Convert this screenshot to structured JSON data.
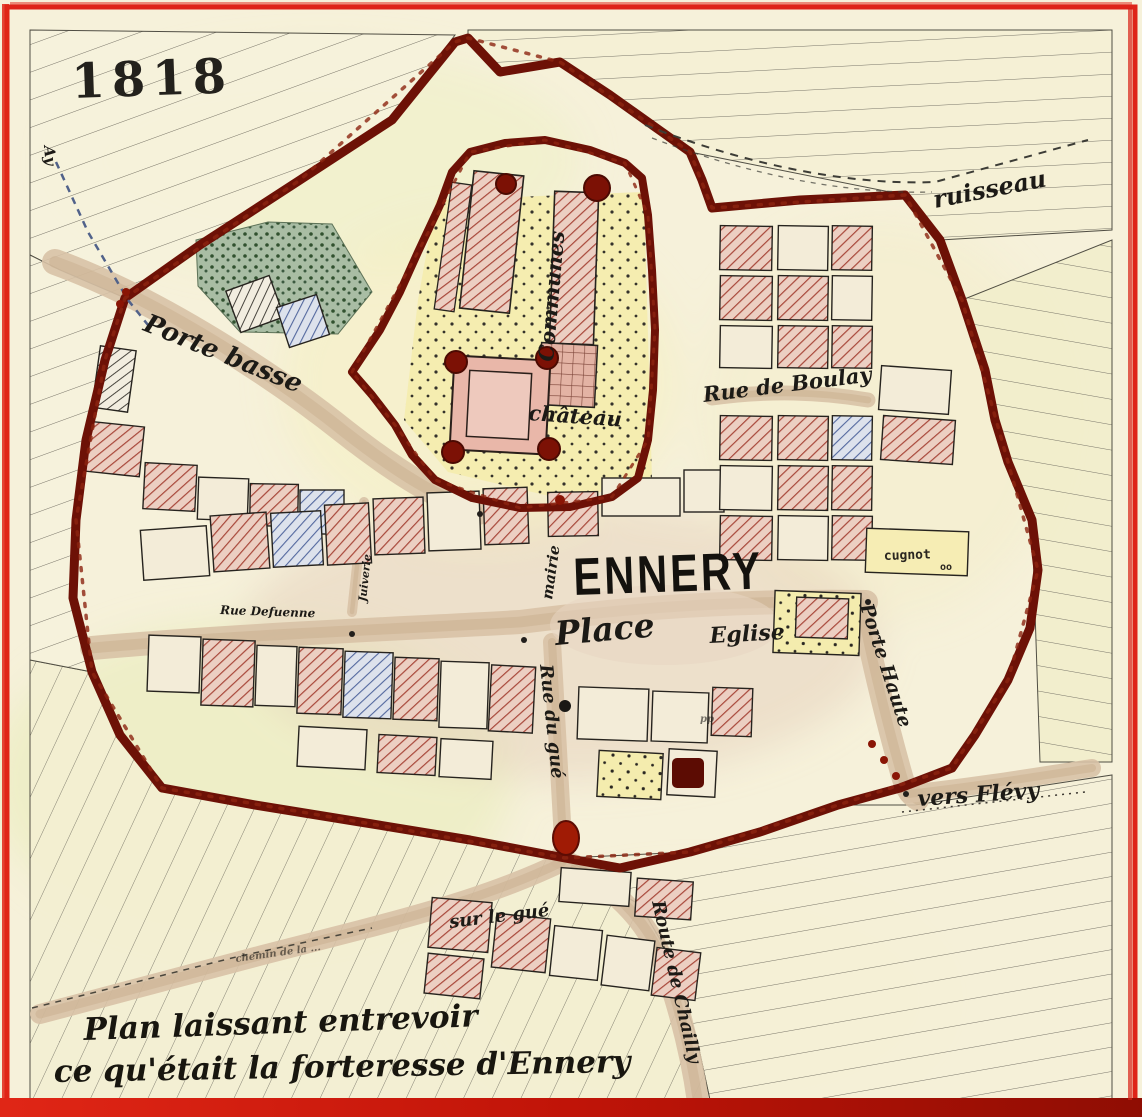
{
  "canvas": {
    "width": 1142,
    "height": 1117
  },
  "palette": {
    "paper": "#f6f1da",
    "frame_red": "#de2418",
    "wall_red": "#6d1106",
    "hatch_red": "#a8473a",
    "hatch_blue": "#53689e",
    "road_tan": "#d8c2a6",
    "grove_green": "#a9bda4",
    "moat_yellow": "#f4ecae",
    "keep_pink": "#e9b7a9",
    "ink": "#1c1a16"
  },
  "labels": [
    {
      "id": "date-1818",
      "text": "1818",
      "x": 72,
      "y": 98,
      "rot": -2,
      "size": 48,
      "cls": "date"
    },
    {
      "id": "ay",
      "text": "Ay",
      "x": 44,
      "y": 146,
      "rot": 85,
      "size": 15,
      "cls": "script-small"
    },
    {
      "id": "ruisseau",
      "text": "ruisseau",
      "x": 935,
      "y": 208,
      "rot": -11,
      "size": 24,
      "cls": "script"
    },
    {
      "id": "porte-basse",
      "text": "Porte basse",
      "x": 142,
      "y": 330,
      "rot": 22,
      "size": 26,
      "cls": "script"
    },
    {
      "id": "communes",
      "text": "Communes",
      "x": 553,
      "y": 362,
      "rot": -85,
      "size": 21,
      "cls": "script"
    },
    {
      "id": "chateau",
      "text": "château",
      "x": 528,
      "y": 420,
      "rot": 4,
      "size": 21,
      "cls": "script"
    },
    {
      "id": "rue-de-boulay",
      "text": "Rue de Boulay",
      "x": 704,
      "y": 402,
      "rot": -7,
      "size": 21,
      "cls": "script"
    },
    {
      "id": "mairie",
      "text": "mairie",
      "x": 552,
      "y": 600,
      "rot": -82,
      "size": 15,
      "cls": "script-small"
    },
    {
      "id": "ennery",
      "text": "ENNERY",
      "x": 574,
      "y": 595,
      "rot": -2,
      "size": 44,
      "cls": "block"
    },
    {
      "id": "place",
      "text": "Place",
      "x": 556,
      "y": 645,
      "rot": -5,
      "size": 33,
      "cls": "script"
    },
    {
      "id": "eglise",
      "text": "Eglise",
      "x": 710,
      "y": 643,
      "rot": -3,
      "size": 22,
      "cls": "script"
    },
    {
      "id": "rue-defuenne",
      "text": "Rue Defuenne",
      "x": 220,
      "y": 614,
      "rot": 2,
      "size": 12,
      "cls": "script-small"
    },
    {
      "id": "juiverie",
      "text": "Juiverie",
      "x": 366,
      "y": 602,
      "rot": -84,
      "size": 11,
      "cls": "script-small"
    },
    {
      "id": "cugnot",
      "text": "cugnot",
      "x": 884,
      "y": 560,
      "rot": -2,
      "size": 13,
      "cls": "print"
    },
    {
      "id": "cugnot-oo",
      "text": "oo",
      "x": 940,
      "y": 570,
      "rot": 0,
      "size": 10,
      "cls": "print"
    },
    {
      "id": "porte-haute",
      "text": "Porte Haute",
      "x": 860,
      "y": 606,
      "rot": 72,
      "size": 19,
      "cls": "script"
    },
    {
      "id": "rue-du-gue",
      "text": "Rue du gué",
      "x": 540,
      "y": 665,
      "rot": 84,
      "size": 18,
      "cls": "script"
    },
    {
      "id": "vers-flevy",
      "text": "vers Flévy",
      "x": 918,
      "y": 806,
      "rot": -4,
      "size": 22,
      "cls": "script"
    },
    {
      "id": "sur-le-gue",
      "text": "sur le gué",
      "x": 450,
      "y": 928,
      "rot": -7,
      "size": 18,
      "cls": "script"
    },
    {
      "id": "route-de-chailly",
      "text": "Route de Chailly",
      "x": 652,
      "y": 902,
      "rot": 77,
      "size": 18,
      "cls": "script"
    },
    {
      "id": "chemin",
      "text": "chemin de la ...",
      "x": 236,
      "y": 962,
      "rot": -8,
      "size": 10,
      "cls": "script-faint"
    },
    {
      "id": "pp",
      "text": "pp",
      "x": 700,
      "y": 722,
      "rot": 0,
      "size": 10,
      "cls": "script-faint"
    },
    {
      "id": "caption-line-1",
      "text": "Plan laissant entrevoir",
      "x": 84,
      "y": 1040,
      "rot": -2,
      "size": 31,
      "cls": "caption"
    },
    {
      "id": "caption-line-2",
      "text": "ce qu'était la forteresse d'Ennery",
      "x": 54,
      "y": 1082,
      "rot": -1,
      "size": 31,
      "cls": "caption"
    }
  ]
}
